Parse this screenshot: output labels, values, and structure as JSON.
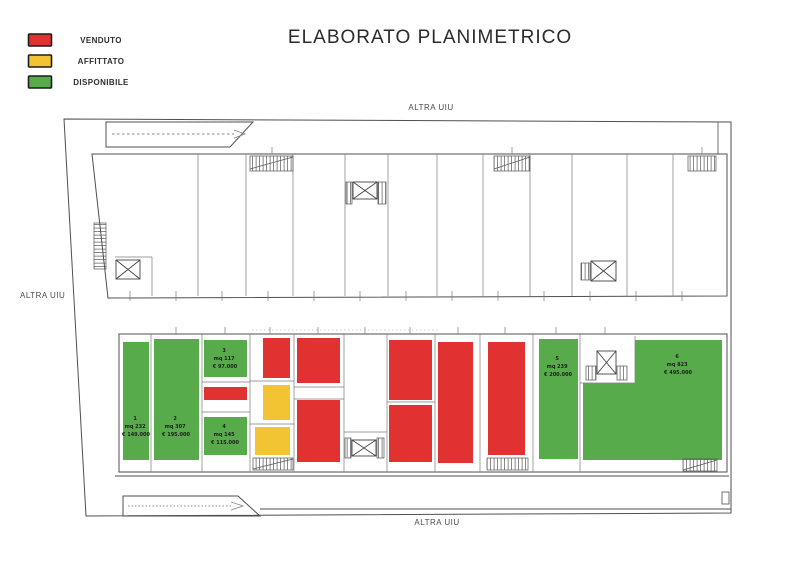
{
  "title": "ELABORATO PLANIMETRICO",
  "legend": {
    "items": [
      {
        "label": "VENDUTO",
        "status": "venduto"
      },
      {
        "label": "AFFITTATO",
        "status": "affittato"
      },
      {
        "label": "DISPONIBILE",
        "status": "disponibile"
      }
    ]
  },
  "colors": {
    "venduto": "#e13231",
    "affittato": "#f2c434",
    "disponibile": "#57ab4a"
  },
  "labels": {
    "altra_uiu_top": "ALTRA UIU",
    "altra_uiu_left": "ALTRA UIU",
    "altra_uiu_bottom": "ALTRA UIU"
  },
  "units": [
    {
      "id": "1",
      "area": "mq 232",
      "price": "€ 149.000",
      "status": "disponibile"
    },
    {
      "id": "2",
      "area": "mq 307",
      "price": "€ 195.000",
      "status": "disponibile"
    },
    {
      "id": "3",
      "area": "mq 117",
      "price": "€ 97.000",
      "status": "disponibile"
    },
    {
      "id": "4",
      "area": "mq 145",
      "price": "€ 115.000",
      "status": "disponibile"
    },
    {
      "id": "5",
      "area": "mq 239",
      "price": "€ 200.000",
      "status": "disponibile"
    },
    {
      "id": "6",
      "area": "mq 823",
      "price": "€ 495.000",
      "status": "disponibile"
    }
  ]
}
